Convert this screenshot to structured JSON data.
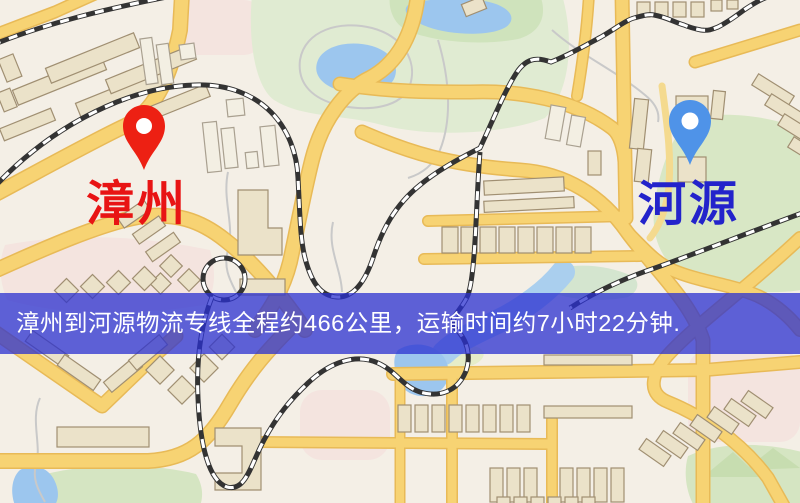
{
  "map": {
    "origin": {
      "label": "漳州",
      "marker_icon": "red-map-pin-icon"
    },
    "destination": {
      "label": "河源",
      "marker_icon": "blue-map-pin-icon"
    }
  },
  "banner": {
    "text": "漳州到河源物流专线全程约466公里，运输时间约7小时22分钟."
  },
  "colors": {
    "origin_pin": "#ed2013",
    "origin_label": "#e81414",
    "destination_pin": "#4f93e8",
    "destination_label": "#2323cb",
    "banner_bg": "rgba(43,48,208,0.75)",
    "banner_text": "#ffffff"
  }
}
